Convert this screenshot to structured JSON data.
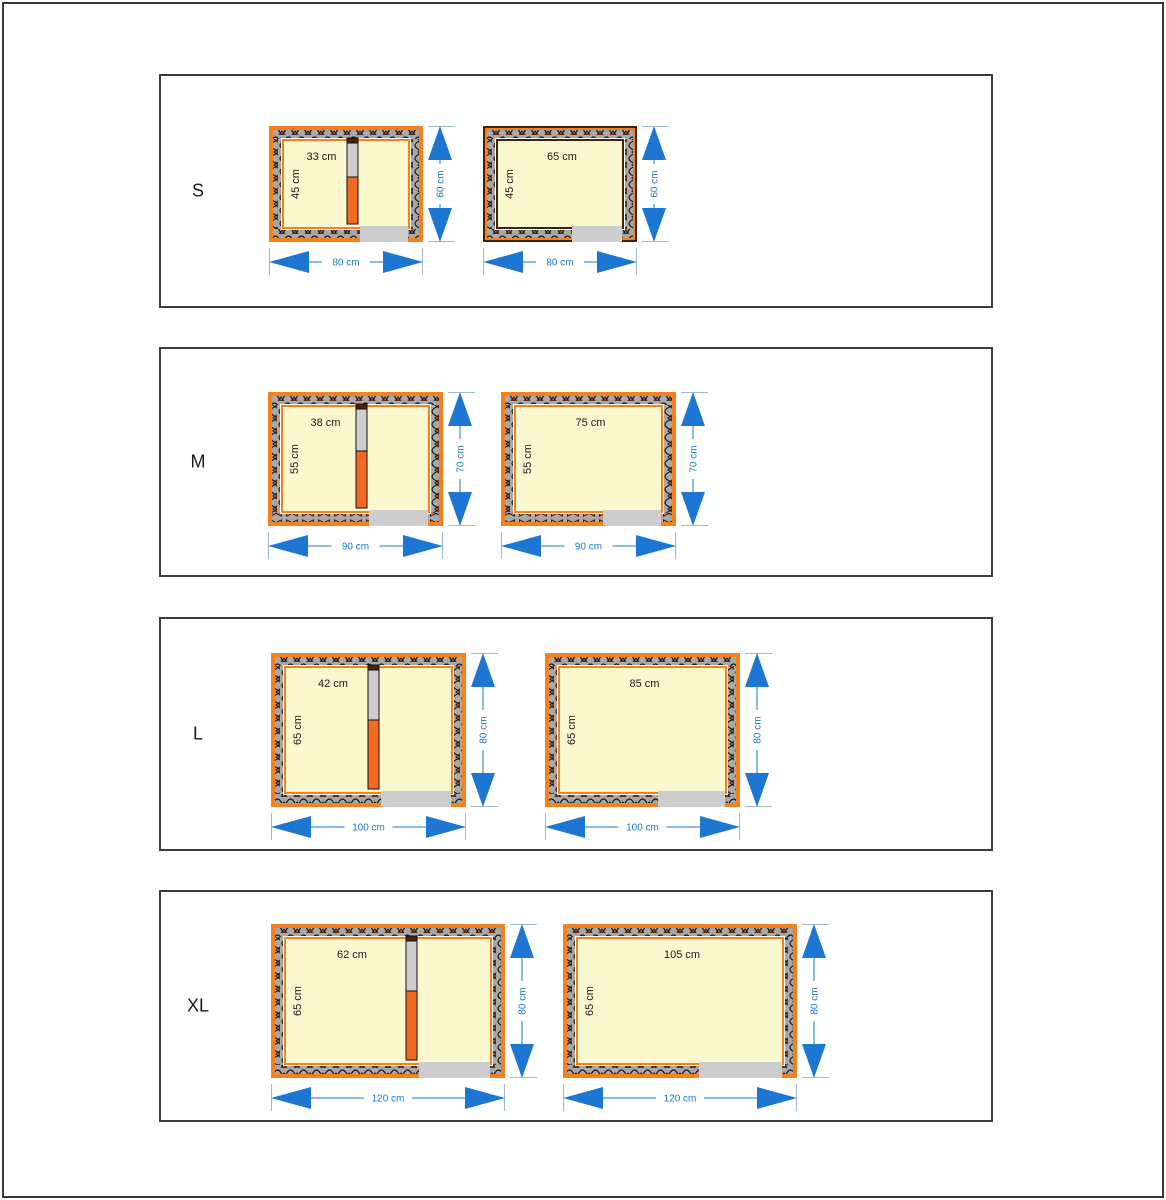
{
  "units": "cm",
  "colors": {
    "orange": "#F4811E",
    "divider_orange": "#F26A22",
    "divider_cap": "#4A2208",
    "wall_gray": "#A8A8A8",
    "entrance": "#CDCDCD",
    "cream": "#FBF7CF",
    "dim_blue": "#1C76D2",
    "extension_line": "#9DB6DD",
    "dark_border": "#42210B",
    "frame": "#3A3A3A"
  },
  "rows": [
    {
      "label": "S",
      "diagrams": [
        {
          "style": "divided",
          "border": "orange",
          "divider_cm": 33,
          "interior_w_cm": 65,
          "outer_w_cm": 80,
          "outer_h_cm": 60,
          "labels": {
            "top": "33 cm",
            "side": "45 cm",
            "width": "80 cm",
            "height": "60 cm"
          }
        },
        {
          "style": "open",
          "border": "dark",
          "interior_w_cm": 65,
          "outer_w_cm": 80,
          "outer_h_cm": 60,
          "labels": {
            "top": "65 cm",
            "side": "45 cm",
            "width": "80 cm",
            "height": "60 cm"
          }
        }
      ]
    },
    {
      "label": "M",
      "diagrams": [
        {
          "style": "divided",
          "border": "orange",
          "divider_cm": 38,
          "interior_w_cm": 75,
          "outer_w_cm": 90,
          "outer_h_cm": 70,
          "labels": {
            "top": "38 cm",
            "side": "55 cm",
            "width": "90 cm",
            "height": "70 cm"
          }
        },
        {
          "style": "open",
          "border": "orange",
          "interior_w_cm": 75,
          "outer_w_cm": 90,
          "outer_h_cm": 70,
          "labels": {
            "top": "75 cm",
            "side": "55 cm",
            "width": "90 cm",
            "height": "70 cm"
          }
        }
      ]
    },
    {
      "label": "L",
      "diagrams": [
        {
          "style": "divided",
          "border": "orange",
          "divider_cm": 42,
          "interior_w_cm": 85,
          "outer_w_cm": 100,
          "outer_h_cm": 80,
          "labels": {
            "top": "42 cm",
            "side": "65 cm",
            "width": "100 cm",
            "height": "80 cm"
          }
        },
        {
          "style": "open",
          "border": "orange",
          "interior_w_cm": 85,
          "outer_w_cm": 100,
          "outer_h_cm": 80,
          "labels": {
            "top": "85 cm",
            "side": "65 cm",
            "width": "100 cm",
            "height": "80 cm"
          }
        }
      ]
    },
    {
      "label": "XL",
      "diagrams": [
        {
          "style": "divided",
          "border": "orange",
          "divider_cm": 62,
          "interior_w_cm": 105,
          "outer_w_cm": 120,
          "outer_h_cm": 80,
          "labels": {
            "top": "62 cm",
            "side": "65 cm",
            "width": "120 cm",
            "height": "80 cm"
          }
        },
        {
          "style": "open",
          "border": "orange",
          "interior_w_cm": 105,
          "outer_w_cm": 120,
          "outer_h_cm": 80,
          "labels": {
            "top": "105 cm",
            "side": "65 cm",
            "width": "120 cm",
            "height": "80 cm"
          }
        }
      ]
    }
  ]
}
